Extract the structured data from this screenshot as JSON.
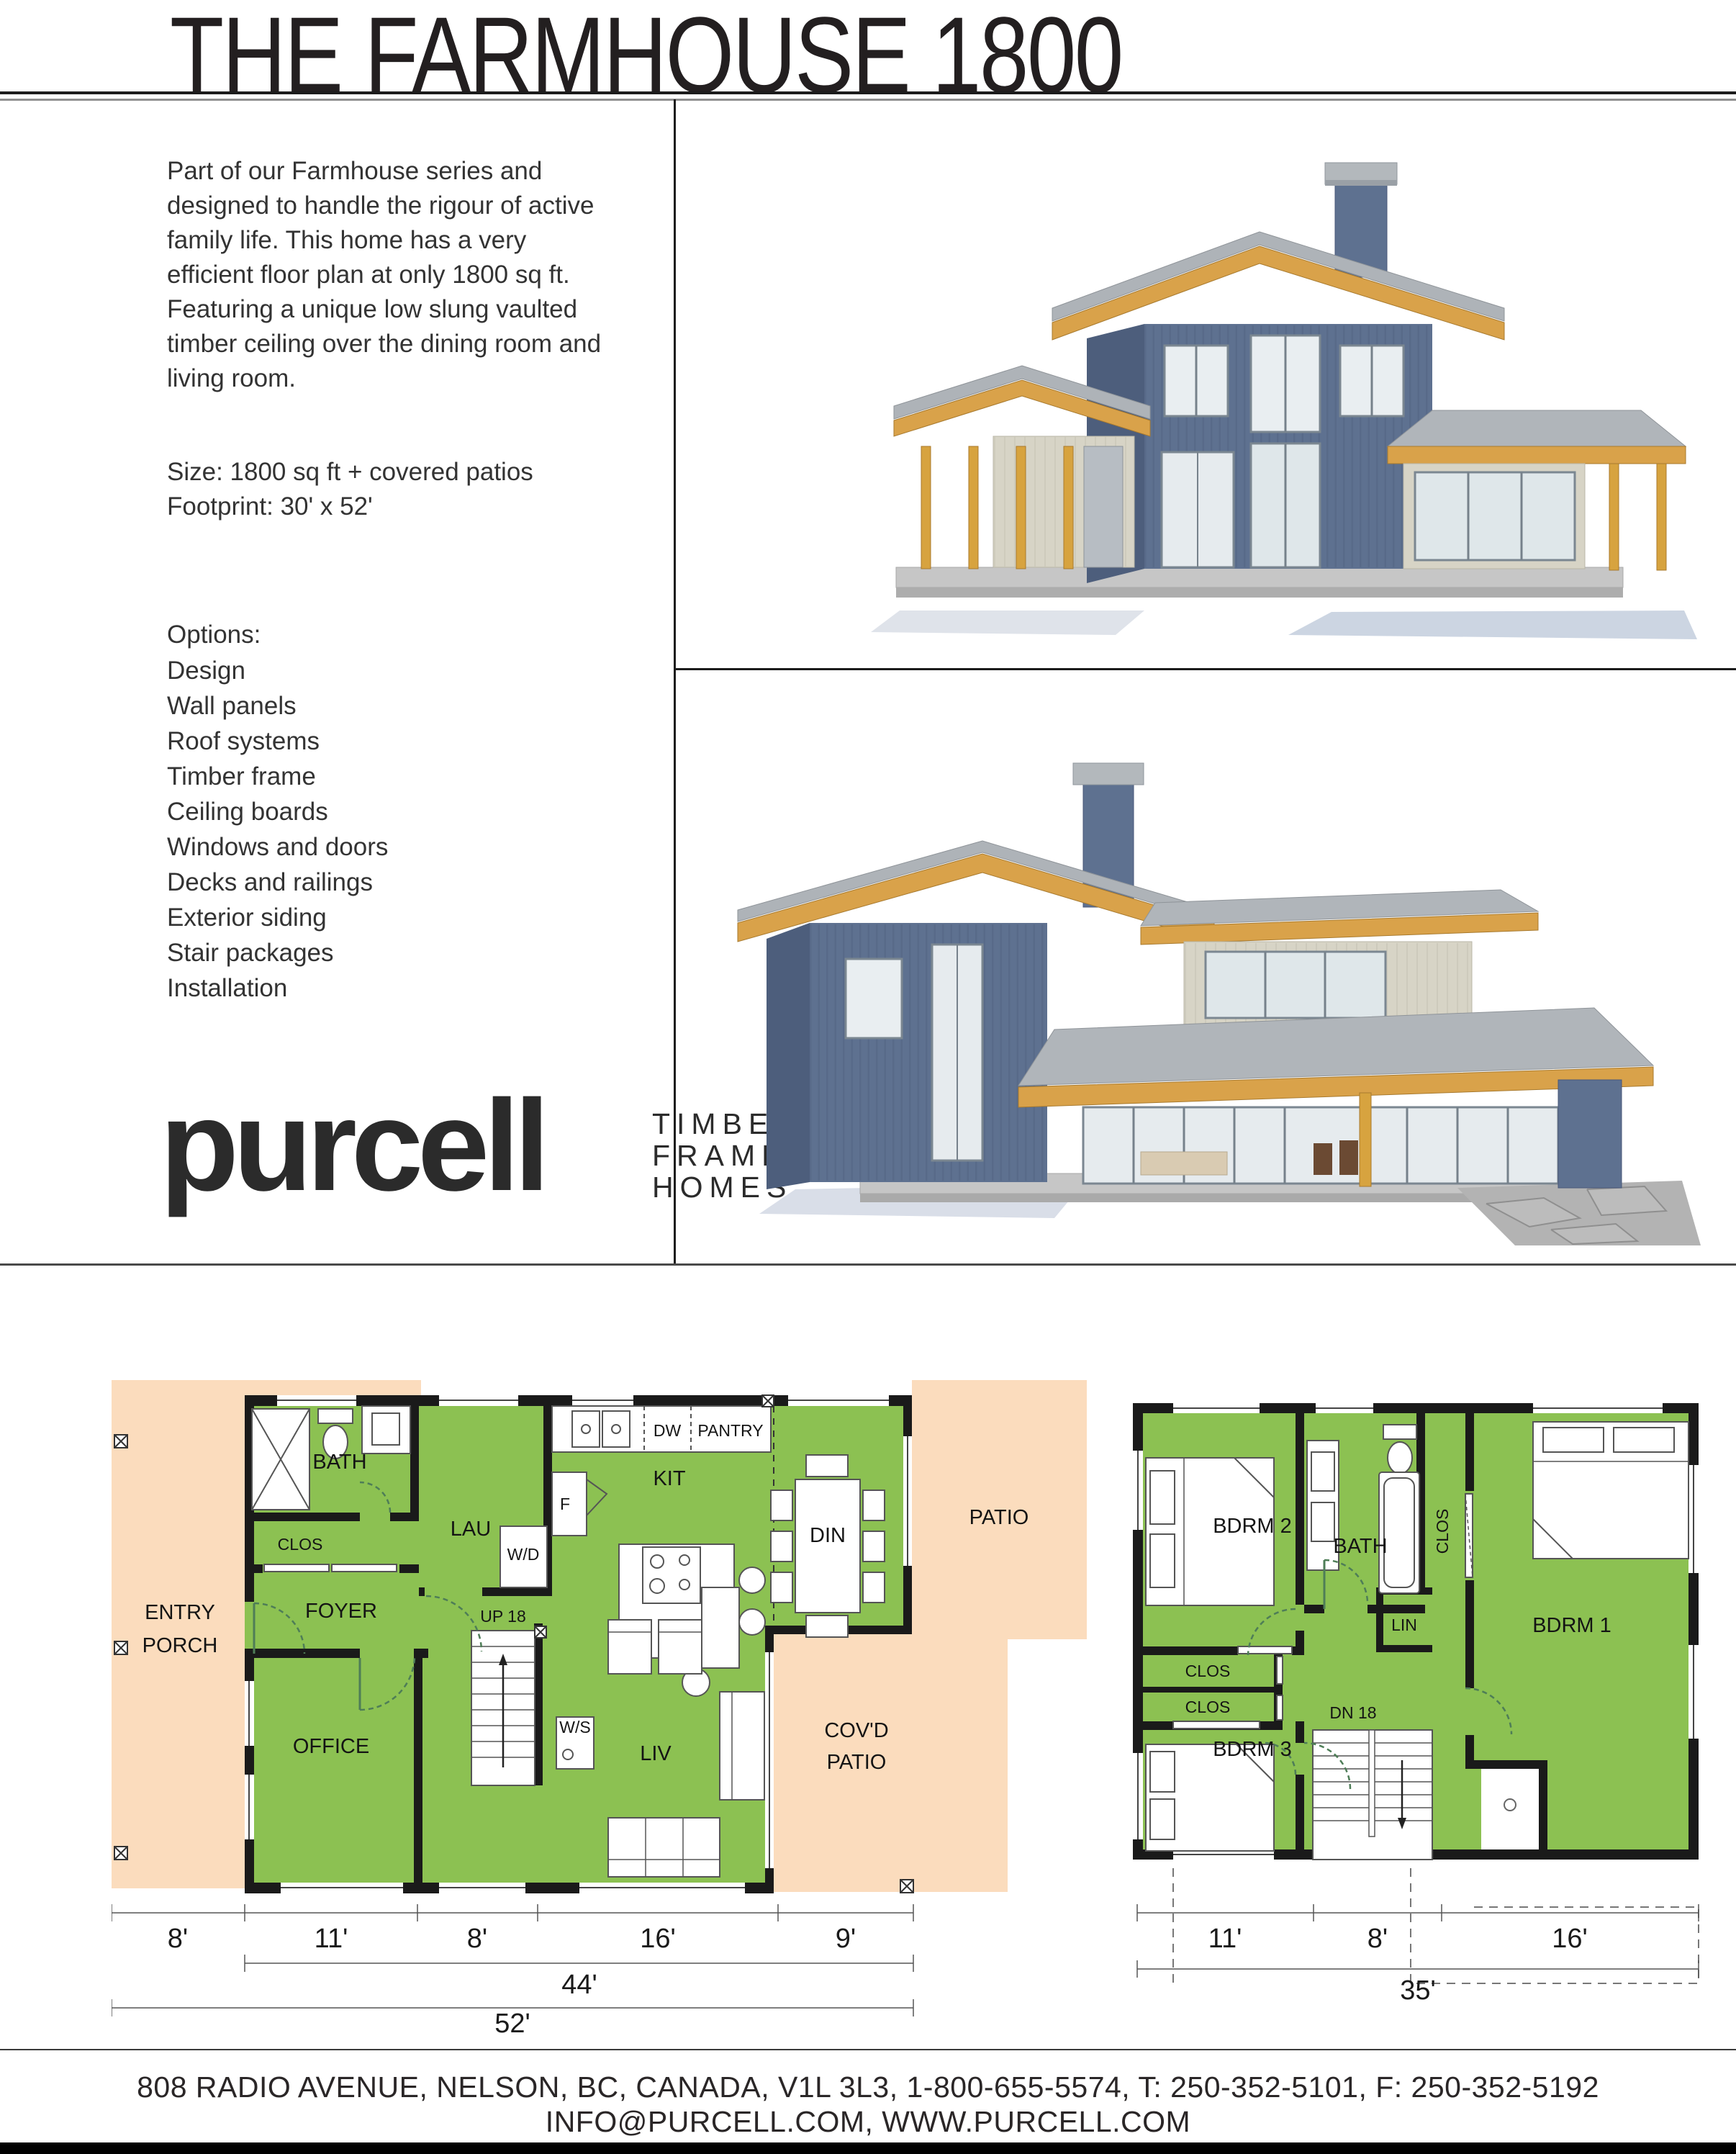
{
  "page_title": "THE FARMHOUSE 1800",
  "intro": {
    "paragraph": "Part of our Farmhouse series and designed to handle the rigour of active family life. This home has a very efficient floor plan at only 1800 sq ft. Featuring a unique low slung vaulted timber ceiling over the dining room and living room.",
    "size_line": "Size: 1800 sq ft + covered patios",
    "footprint_line": "Footprint: 30' x 52'"
  },
  "options": {
    "heading": "Options:",
    "items": [
      "Design",
      "Wall panels",
      "Roof systems",
      "Timber frame",
      "Ceiling boards",
      "Windows and doors",
      "Decks and railings",
      "Exterior siding",
      "Stair packages",
      "Installation"
    ]
  },
  "logo": {
    "wordmark": "purcell",
    "tagline": [
      "TIMBER",
      "FRAME",
      "HOMES"
    ]
  },
  "main_floor": {
    "rooms": {
      "entry_1": "ENTRY",
      "entry_2": "PORCH",
      "bath": "BATH",
      "clos": "CLOS",
      "lau": "LAU",
      "wd": "W/D",
      "foyer": "FOYER",
      "office": "OFFICE",
      "up": "UP 18",
      "fridge": "F",
      "kit": "KIT",
      "dw": "DW",
      "pantry": "PANTRY",
      "din": "DIN",
      "ws": "W/S",
      "liv": "LIV",
      "patio": "PATIO",
      "covd_1": "COV'D",
      "covd_2": "PATIO"
    },
    "dims": [
      "8'",
      "11'",
      "8'",
      "16'",
      "9'"
    ],
    "dim_sub": "44'",
    "dim_total": "52'"
  },
  "upper_floor": {
    "rooms": {
      "bdrm2": "BDRM 2",
      "bath": "BATH",
      "clos_v": "CLOS",
      "lin": "LIN",
      "bdrm1": "BDRM 1",
      "clos_a": "CLOS",
      "clos_b": "CLOS",
      "dn": "DN 18",
      "bdrm3": "BDRM 3"
    },
    "dims": [
      "11'",
      "8'",
      "16'"
    ],
    "dim_total": "35'"
  },
  "footer": {
    "line1": "808 RADIO AVENUE, NELSON, BC, CANADA, V1L 3L3, 1-800-655-5574, T: 250-352-5101, F: 250-352-5192",
    "line2": "INFO@PURCELL.COM, WWW.PURCELL.COM"
  },
  "colors": {
    "plan_green": "#8cc152",
    "plan_peach": "#fbdcbd",
    "timber": "#d9a24a",
    "siding_blue": "#5e7190",
    "roof_gray": "#aeb3b8",
    "shingle": "#d7d4c6"
  }
}
